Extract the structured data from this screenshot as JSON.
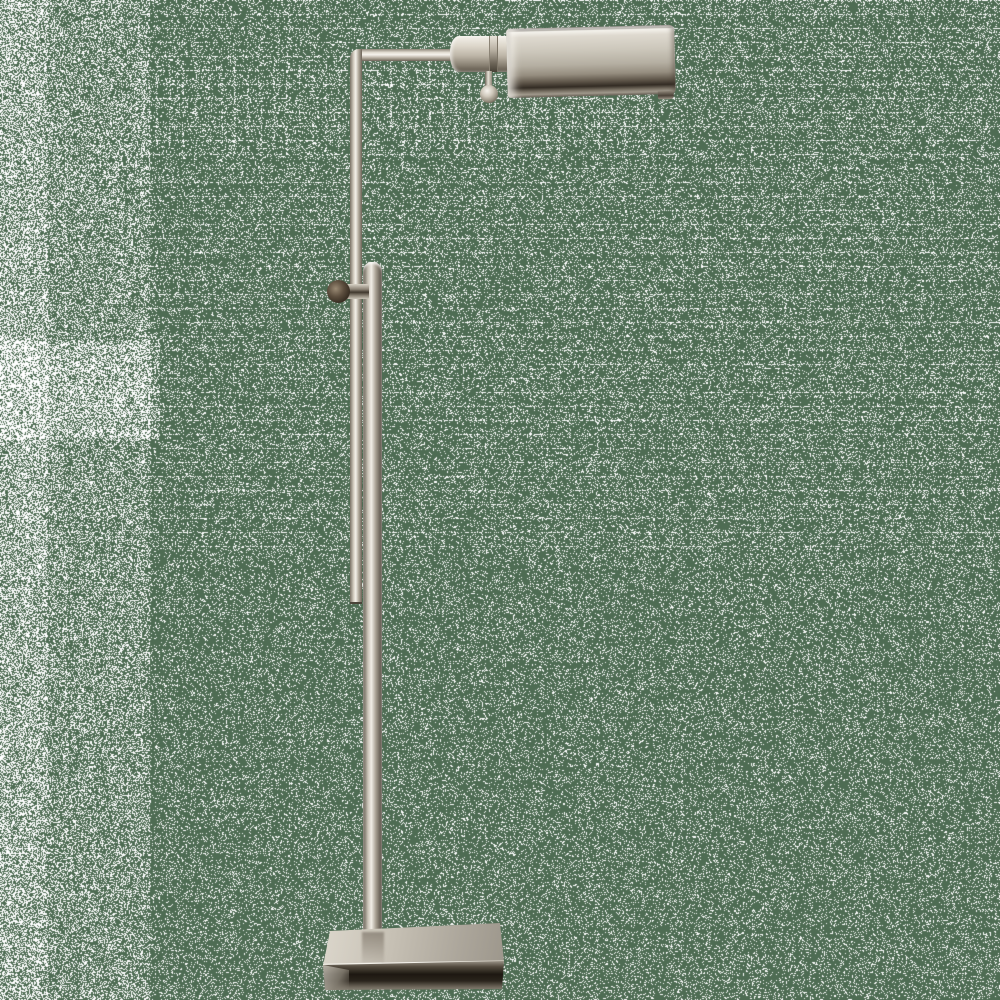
{
  "image_type": "product-photo",
  "subject": {
    "name": "adjustable pharmacy floor lamp",
    "finish": "polished nickel",
    "orientation": "shade arm extends to the right",
    "parts": {
      "shade": "horizontal half-cylinder task shade",
      "socket": "cylindrical socket housing with seam ring",
      "finial": "ball pull switch hanging below socket",
      "arm": "right-angle arm from thin upper pole",
      "upper_pole": "thin telescoping pole",
      "lower_pole": "thick main column with rounded cap",
      "knob": "side-mounted height adjustment thumb knob",
      "base": "rectangular beveled plinth base"
    }
  },
  "background": {
    "style": "flat green field covered in repeating white speckle dither noise, denser along the left edge",
    "base_color": "#4e6c53",
    "speckle_color": "#ffffff"
  },
  "palette": {
    "nickel_highlight": "#f6f4ee",
    "nickel_light": "#ddd8cd",
    "nickel_mid": "#b5afa2",
    "nickel_shadow": "#6e675c",
    "nickel_dark": "#2a241d",
    "knob_brown": "#372d22"
  }
}
